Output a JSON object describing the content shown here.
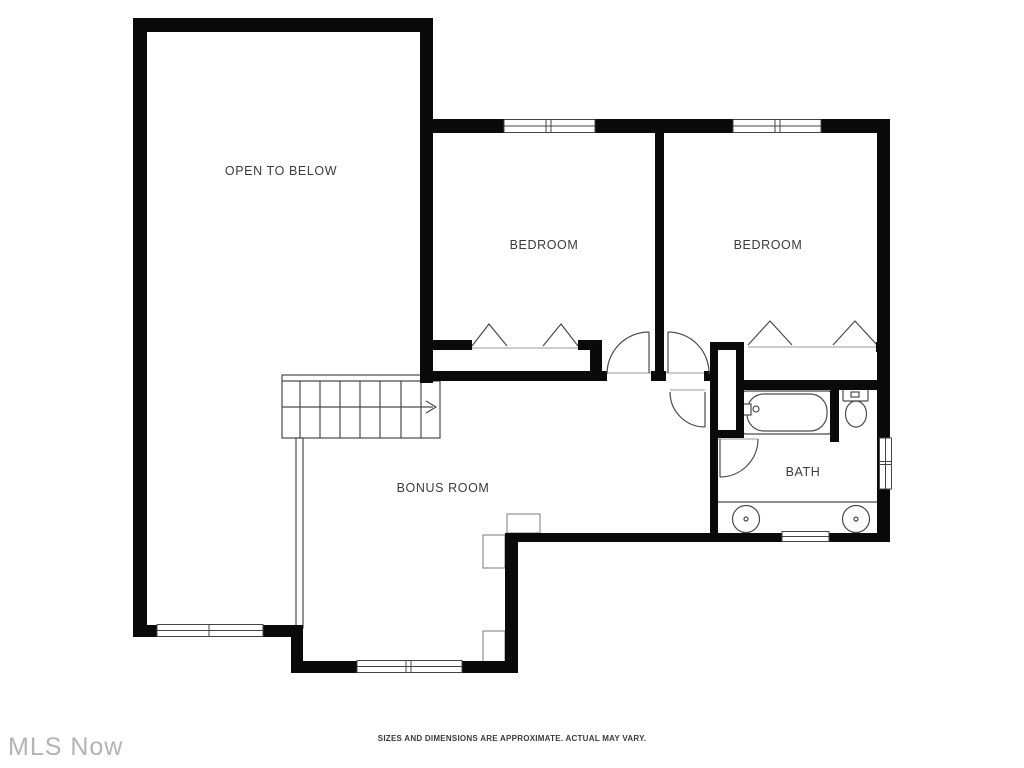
{
  "canvas": {
    "width": 1024,
    "height": 768,
    "background": "#ffffff"
  },
  "watermark": {
    "text": "MLS Now"
  },
  "footer": {
    "disclaimer": "SIZES AND DIMENSIONS ARE APPROXIMATE. ACTUAL MAY VARY."
  },
  "floorplan": {
    "rooms": [
      {
        "id": "open-to-below",
        "label": "OPEN TO BELOW"
      },
      {
        "id": "bedroom-1",
        "label": "BEDROOM"
      },
      {
        "id": "bedroom-2",
        "label": "BEDROOM"
      },
      {
        "id": "bonus-room",
        "label": "BONUS ROOM"
      },
      {
        "id": "bath",
        "label": "BATH"
      }
    ],
    "icons": [
      "stairs-icon",
      "stairs-direction-arrow-icon",
      "railing-icon",
      "bathtub-icon",
      "faucet-icon",
      "toilet-icon",
      "sink-icon",
      "door-swing-icon",
      "window-icon",
      "bifold-closet-door-icon",
      "chase-icon",
      "fireplace-icon"
    ],
    "colors": {
      "wall": "#0a0a0a",
      "fixture_line": "#4a4a4a",
      "label_text": "#3b3b3b",
      "watermark_text": "#b3b3b3",
      "disclaimer_text": "#3a3a3a"
    }
  }
}
